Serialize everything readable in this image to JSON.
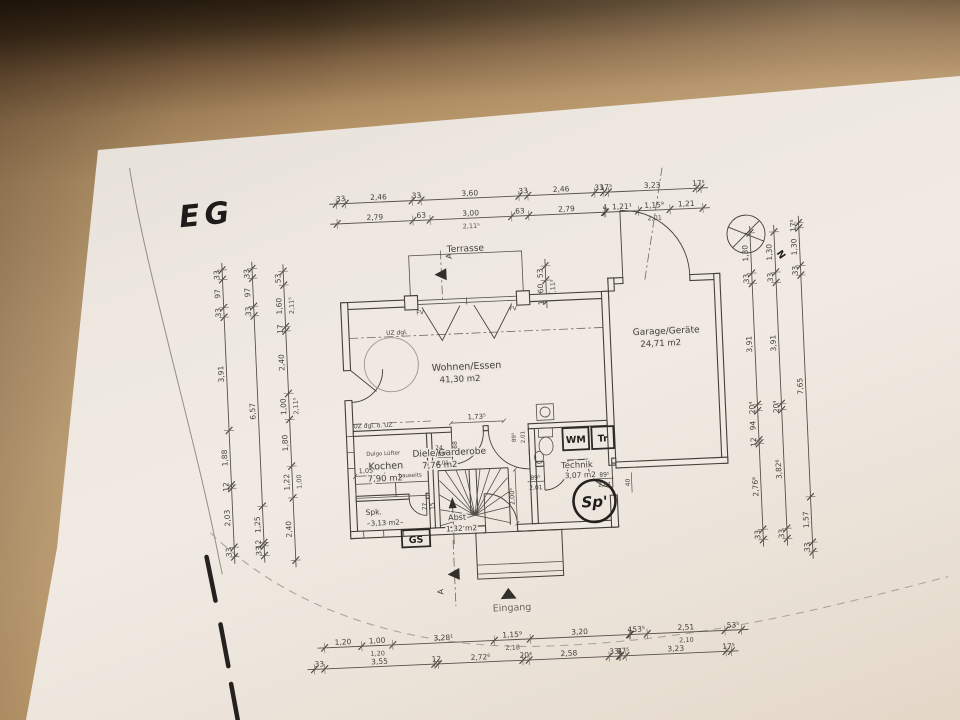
{
  "scene": {
    "desk_color": "#c9a778",
    "paper_color": "#eee8e1",
    "ink_color": "#45403a",
    "marker_color": "#24211e"
  },
  "titles": {
    "floor_mark": "EG",
    "north": "N",
    "section": "A"
  },
  "rooms": {
    "wohnen": {
      "name": "Wohnen/Essen",
      "area": "41,30 m2"
    },
    "garage": {
      "name": "Garage/Geräte",
      "area": "24,71 m2"
    },
    "kochen": {
      "name": "Kochen",
      "area": "7,90 m2"
    },
    "diele": {
      "name": "Diele/Garderobe",
      "area": "7,76 m2"
    },
    "technik": {
      "name": "Technik",
      "area": "3,07 m2"
    },
    "spk": {
      "name": "Spk.",
      "area": "3,13 m2"
    },
    "abst": {
      "name": "Abst",
      "area": "1,32 m2"
    }
  },
  "annotations": {
    "terrasse": "Terrasse",
    "eingang": "Eingang",
    "fv": "FV",
    "uz_top": "UZ dgl.",
    "uz_mid": "UZ dgl. o. UZ",
    "lufter": "Dulgo Lüfter",
    "bauseits": "bauseits"
  },
  "fixtures": {
    "wm": "WM",
    "tr": "Tr",
    "gs": "GS",
    "sp": "Sp'"
  },
  "dims": {
    "d_173": "1,73⁵",
    "d_68": "68",
    "d_24": "24",
    "d_895": "89⁵",
    "d_201": "2,01",
    "d_2005": "2,00⁵",
    "d_40": "40",
    "d_105": "1,05",
    "d_77": "77",
    "d_15": "15"
  },
  "chains": {
    "top_row1": [
      {
        "t": "33",
        "m": 0.33
      },
      {
        "t": "2,46",
        "m": 2.46
      },
      {
        "t": "33",
        "m": 0.33
      },
      {
        "t": "3,60",
        "m": 3.6
      },
      {
        "t": "33",
        "m": 0.33
      },
      {
        "t": "2,46",
        "m": 2.46
      },
      {
        "t": "33",
        "m": 0.33
      },
      {
        "t": "17⁵",
        "m": 0.175
      },
      {
        "t": "3,23",
        "m": 3.23
      },
      {
        "t": "17⁵",
        "m": 0.175
      }
    ],
    "top_row2": [
      {
        "t": "2,79",
        "m": 2.79
      },
      {
        "t": "63",
        "m": 0.63
      },
      {
        "t": "3,00",
        "m": 3.0,
        "s": "2,11⁵"
      },
      {
        "t": "63",
        "m": 0.63
      },
      {
        "t": "2,79",
        "m": 2.79
      },
      {
        "t": "4",
        "m": 0.04
      },
      {
        "t": "1,21¹",
        "m": 1.211
      },
      {
        "t": "1,15⁹",
        "m": 1.159,
        "s": "2,01"
      },
      {
        "t": "1,21",
        "m": 1.21
      }
    ],
    "bottom_row1": [
      {
        "t": "1,20",
        "m": 1.2
      },
      {
        "t": "1,00",
        "m": 1.0,
        "s": "1,20"
      },
      {
        "t": "3,28¹",
        "m": 3.281
      },
      {
        "t": "1,15⁹",
        "m": 1.159,
        "s": "2,18"
      },
      {
        "t": "3,20",
        "m": 3.2
      },
      {
        "t": "4",
        "m": 0.04
      },
      {
        "t": "53⁵",
        "m": 0.535
      },
      {
        "t": "2,51",
        "m": 2.51,
        "s": "2,10"
      },
      {
        "t": "53⁵",
        "m": 0.535
      }
    ],
    "bottom_row2": [
      {
        "t": "33",
        "m": 0.33
      },
      {
        "t": "3,55",
        "m": 3.55
      },
      {
        "t": "12",
        "m": 0.12
      },
      {
        "t": "2,72⁶",
        "m": 2.726
      },
      {
        "t": "20⁴",
        "m": 0.204
      },
      {
        "t": "2,58",
        "m": 2.58
      },
      {
        "t": "33",
        "m": 0.33
      },
      {
        "t": "4",
        "m": 0.04
      },
      {
        "t": "17⁵",
        "m": 0.175
      },
      {
        "t": "3,23",
        "m": 3.23
      },
      {
        "t": "17⁵",
        "m": 0.175
      }
    ],
    "left_outer": [
      {
        "t": "33",
        "m": 0.33
      },
      {
        "t": "97",
        "m": 0.97
      },
      {
        "t": "33",
        "m": 0.33
      },
      {
        "t": "3,91",
        "m": 3.91
      },
      {
        "t": "1,88",
        "m": 1.88
      },
      {
        "t": "12",
        "m": 0.12
      },
      {
        "t": "2,03",
        "m": 2.03
      },
      {
        "t": "33",
        "m": 0.33
      }
    ],
    "left_middle": [
      {
        "t": "33",
        "m": 0.33
      },
      {
        "t": "97",
        "m": 0.97
      },
      {
        "t": "33",
        "m": 0.33
      },
      {
        "t": "6,57",
        "m": 6.57
      },
      {
        "t": "1,25",
        "m": 1.25
      },
      {
        "t": "12",
        "m": 0.12
      },
      {
        "t": "33",
        "m": 0.33
      }
    ],
    "left_inner": [
      {
        "t": "53",
        "m": 0.53
      },
      {
        "t": "1,60",
        "m": 1.6,
        "s": "2,11⁵"
      },
      {
        "t": "17",
        "m": 0.17
      },
      {
        "t": "2,40",
        "m": 2.4
      },
      {
        "t": "1,00",
        "m": 1.0,
        "s": "2,11⁵"
      },
      {
        "t": "1,80",
        "m": 1.8
      },
      {
        "t": "1,22",
        "m": 1.22,
        "s": "1,00"
      },
      {
        "t": "2,40",
        "m": 2.4
      }
    ],
    "right_outer": [
      {
        "t": "17⁵",
        "m": 0.175
      },
      {
        "t": "1,30",
        "m": 1.3
      },
      {
        "t": "33",
        "m": 0.33
      },
      {
        "t": "7,65",
        "m": 7.65
      },
      {
        "t": "1,57",
        "m": 1.57
      },
      {
        "t": "33",
        "m": 0.33
      }
    ],
    "right_middle": [
      {
        "t": "1,30",
        "m": 1.3
      },
      {
        "t": "33",
        "m": 0.33
      },
      {
        "t": "3,91",
        "m": 3.91
      },
      {
        "t": "20⁴",
        "m": 0.204
      },
      {
        "t": "3,82⁶",
        "m": 3.826
      },
      {
        "t": "33",
        "m": 0.33
      }
    ],
    "right_inner": [
      {
        "t": "1,30",
        "m": 1.3
      },
      {
        "t": "33",
        "m": 0.33
      },
      {
        "t": "3,91",
        "m": 3.91
      },
      {
        "t": "20⁴",
        "m": 0.204
      },
      {
        "t": "94",
        "m": 0.94
      },
      {
        "t": "12",
        "m": 0.12
      },
      {
        "t": "2,76⁶",
        "m": 2.766
      },
      {
        "t": "33",
        "m": 0.33
      }
    ],
    "terrace_side": [
      {
        "t": "53",
        "m": 0.53
      },
      {
        "t": "60",
        "m": 0.6,
        "s": "2,11⁵"
      },
      {
        "t": "17⁵",
        "m": 0.175
      }
    ]
  }
}
